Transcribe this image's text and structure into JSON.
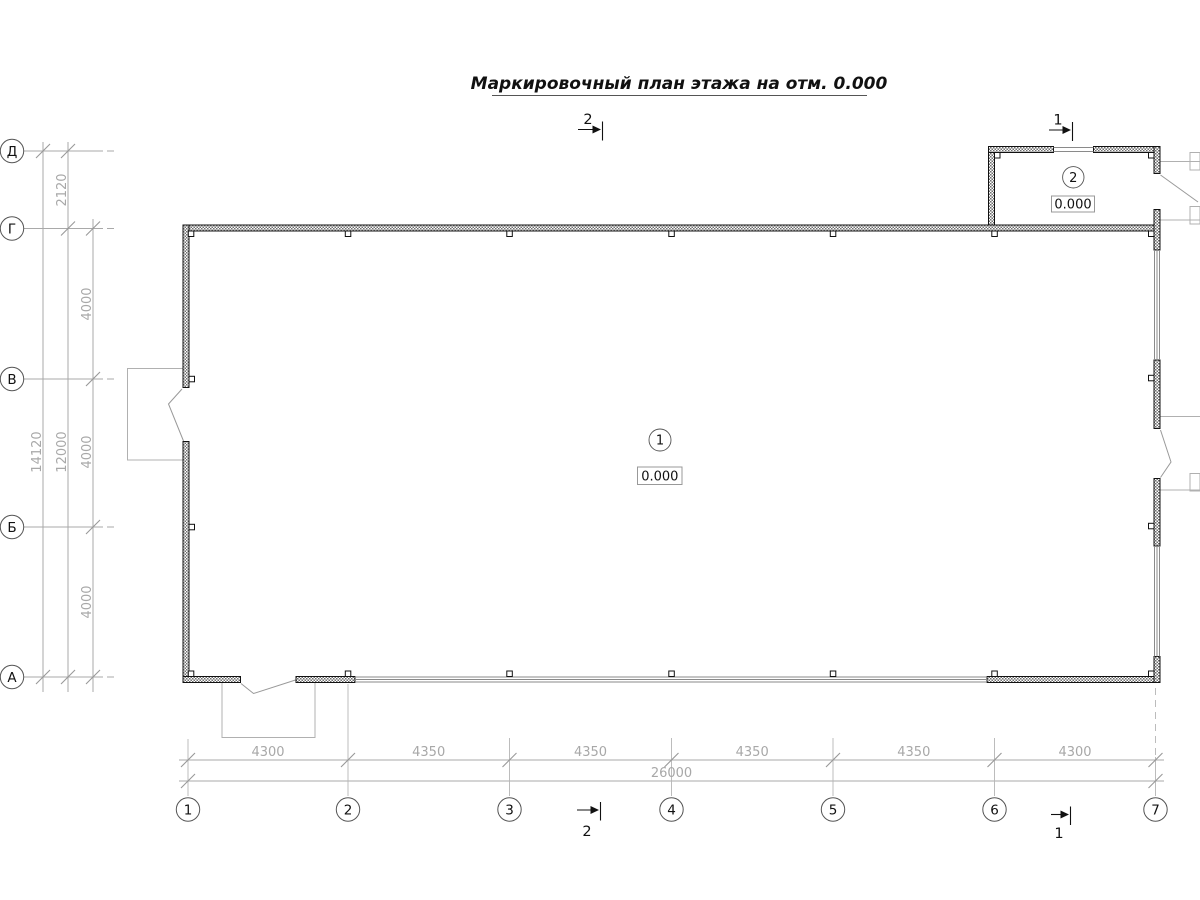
{
  "title": "Маркировочный план этажа на отм. 0.000",
  "axes": {
    "vertical": [
      "Д",
      "Г",
      "В",
      "Б",
      "А"
    ],
    "horizontal": [
      "1",
      "2",
      "3",
      "4",
      "5",
      "6",
      "7"
    ]
  },
  "dimensions": {
    "left": {
      "segment_top": "2120",
      "segments": [
        "4000",
        "4000",
        "4000"
      ],
      "subtotal": "12000",
      "total": "14120"
    },
    "bottom": {
      "segments": [
        "4300",
        "4350",
        "4350",
        "4350",
        "4350",
        "4300"
      ],
      "total": "26000"
    }
  },
  "sections": {
    "section_1": "1",
    "section_2": "2"
  },
  "rooms": [
    {
      "number": "1",
      "elevation": "0.000"
    },
    {
      "number": "2",
      "elevation": "0.000"
    }
  ],
  "colors": {
    "background": "#ffffff",
    "wall_line": "#1a1a1a",
    "thin_line": "#a9a9a9",
    "dim_text": "#a8a8a8",
    "label_text": "#111111"
  }
}
